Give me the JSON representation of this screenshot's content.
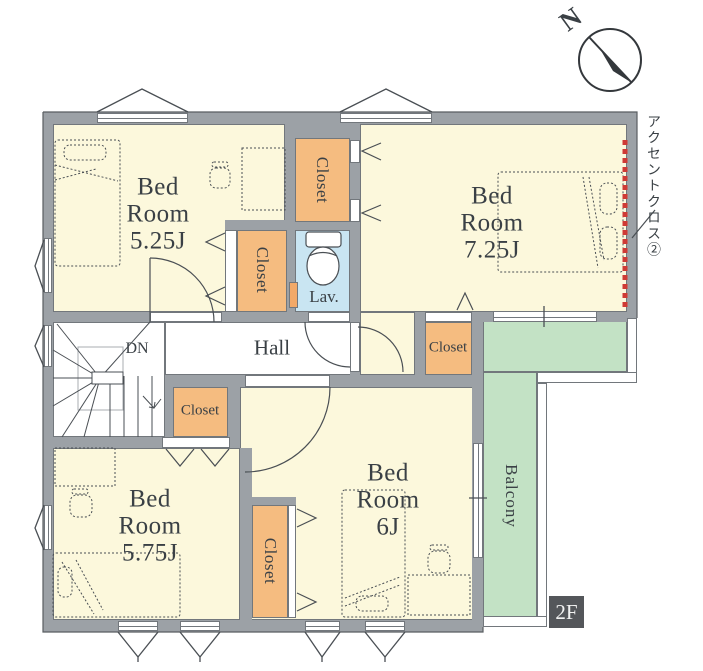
{
  "floor_plan": {
    "floor_badge": "2F",
    "compass": {
      "label": "N"
    },
    "rooms": {
      "bedroom_a": {
        "name_line1": "Bed",
        "name_line2": "Room",
        "size": "5.25J"
      },
      "bedroom_b": {
        "name_line1": "Bed",
        "name_line2": "Room",
        "size": "7.25J"
      },
      "bedroom_c": {
        "name_line1": "Bed",
        "name_line2": "Room",
        "size": "5.75J"
      },
      "bedroom_d": {
        "name_line1": "Bed",
        "name_line2": "Room",
        "size": "6J"
      },
      "hall": {
        "label": "Hall"
      },
      "lavatory": {
        "label": "Lav."
      },
      "balcony": {
        "label": "Balcony"
      },
      "stairs": {
        "direction_label": "DN"
      }
    },
    "closets": {
      "c1_north_middle": "Closet",
      "c2_bedroom_a": "Closet",
      "c3_hall": "Closet",
      "c4_bedroom_b": "Closet",
      "c5_bedroom_d": "Closet"
    },
    "annotations": {
      "accent_cross": "アクセントクロス②"
    },
    "colors": {
      "room_floor": "#FCF8DC",
      "closet": "#F5BC80",
      "balcony": "#C3E2C5",
      "lavatory": "#C9E5F2",
      "wall": "#9CA1A6",
      "accent_line": "#CF3A35",
      "floor_badge_bg": "#54565A",
      "text": "#3A4045"
    }
  }
}
